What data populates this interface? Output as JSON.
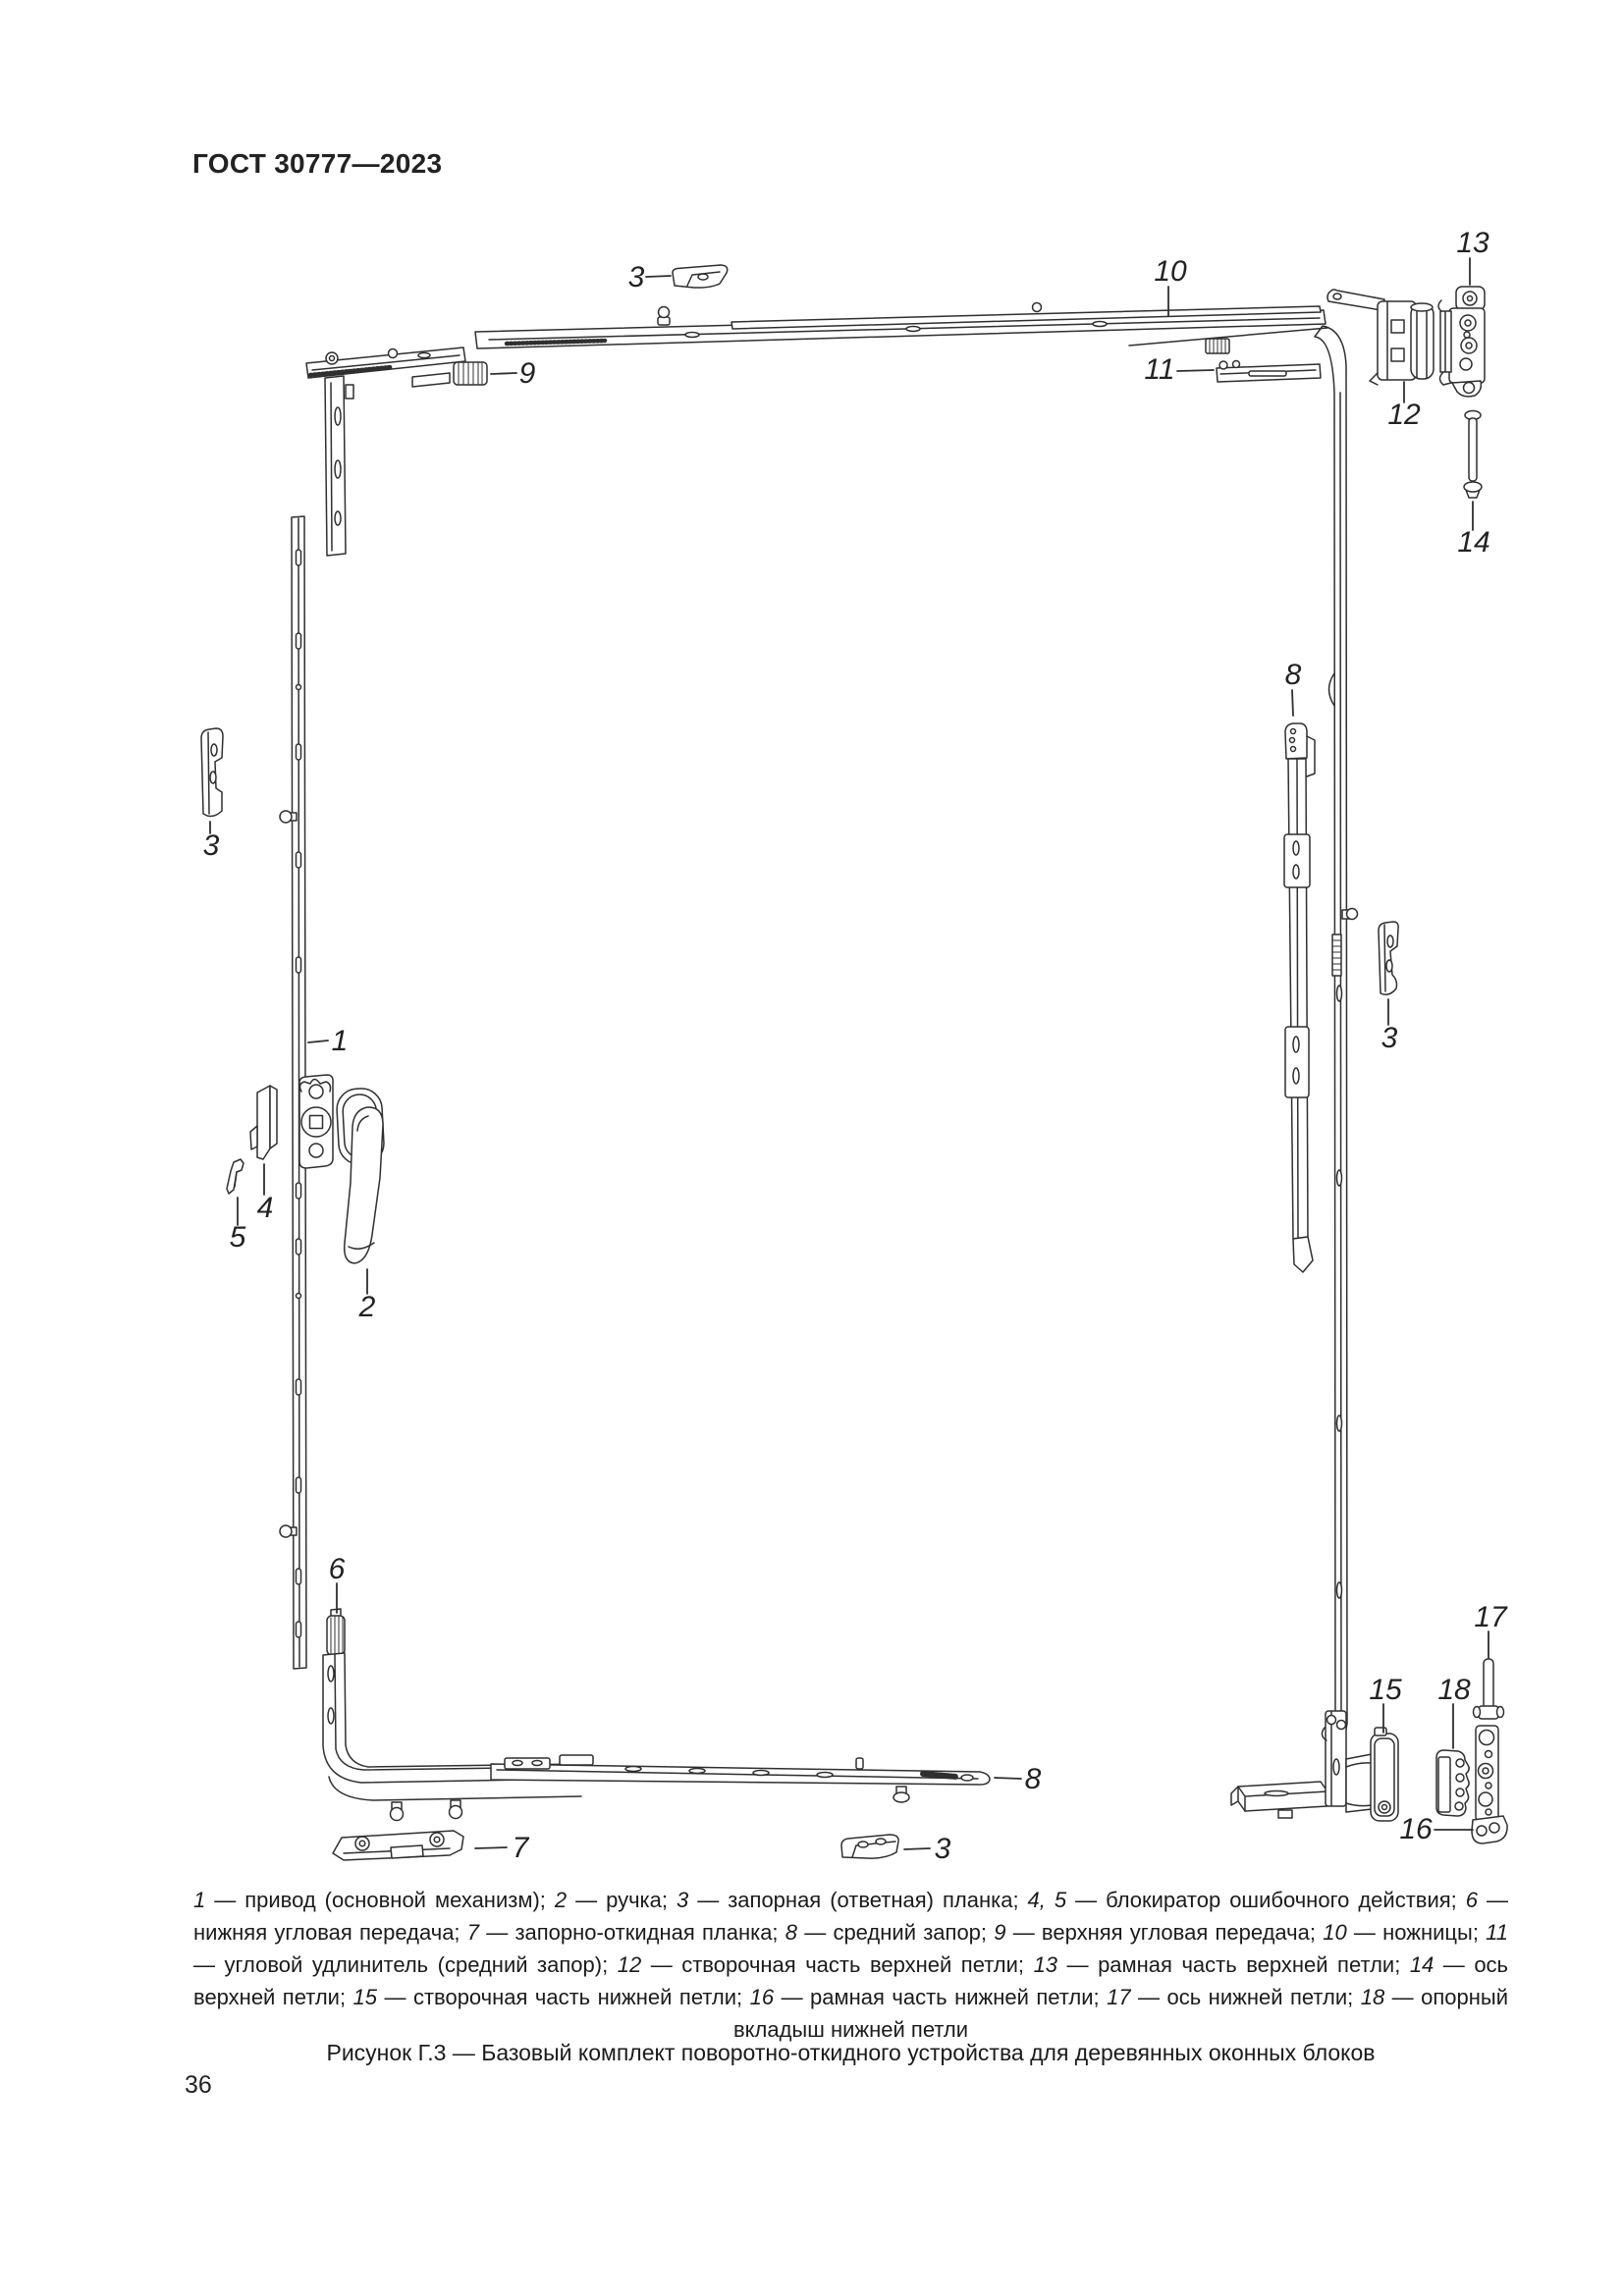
{
  "page": {
    "standard_code": "ГОСТ 30777—2023",
    "page_number": "36"
  },
  "figure": {
    "callouts": [
      {
        "label": "3"
      },
      {
        "label": "10"
      },
      {
        "label": "13"
      },
      {
        "label": "9"
      },
      {
        "label": "11"
      },
      {
        "label": "12"
      },
      {
        "label": "14"
      },
      {
        "label": "3"
      },
      {
        "label": "1"
      },
      {
        "label": "4"
      },
      {
        "label": "5"
      },
      {
        "label": "2"
      },
      {
        "label": "8"
      },
      {
        "label": "3"
      },
      {
        "label": "6"
      },
      {
        "label": "7"
      },
      {
        "label": "8"
      },
      {
        "label": "3"
      },
      {
        "label": "15"
      },
      {
        "label": "18"
      },
      {
        "label": "17"
      },
      {
        "label": "16"
      }
    ],
    "legend": {
      "items": [
        {
          "ref": "1",
          "text": "привод (основной механизм)"
        },
        {
          "ref": "2",
          "text": "ручка"
        },
        {
          "ref": "3",
          "text": "запорная (ответная) планка"
        },
        {
          "ref": "4, 5",
          "text": "блокиратор ошибочного действия"
        },
        {
          "ref": "6",
          "text": "нижняя угловая передача"
        },
        {
          "ref": "7",
          "text": "запорно-откидная планка"
        },
        {
          "ref": "8",
          "text": "средний запор"
        },
        {
          "ref": "9",
          "text": "верхняя угловая передача"
        },
        {
          "ref": "10",
          "text": "ножницы"
        },
        {
          "ref": "11",
          "text": "угловой удлинитель (средний запор)"
        },
        {
          "ref": "12",
          "text": "створочная часть верхней петли"
        },
        {
          "ref": "13",
          "text": "рамная часть верхней петли"
        },
        {
          "ref": "14",
          "text": "ось верхней петли"
        },
        {
          "ref": "15",
          "text": "створочная часть нижней петли"
        },
        {
          "ref": "16",
          "text": "рамная часть нижней петли"
        },
        {
          "ref": "17",
          "text": "ось нижней петли"
        },
        {
          "ref": "18",
          "text": "опорный вкладыш нижней петли"
        }
      ]
    },
    "caption": "Рисунок Г.3 — Базовый комплект поворотно-откидного устройства для деревянных оконных блоков"
  },
  "colors": {
    "ink": "#1c1c1c",
    "line": "#2f2f2f",
    "paper": "#ffffff"
  }
}
